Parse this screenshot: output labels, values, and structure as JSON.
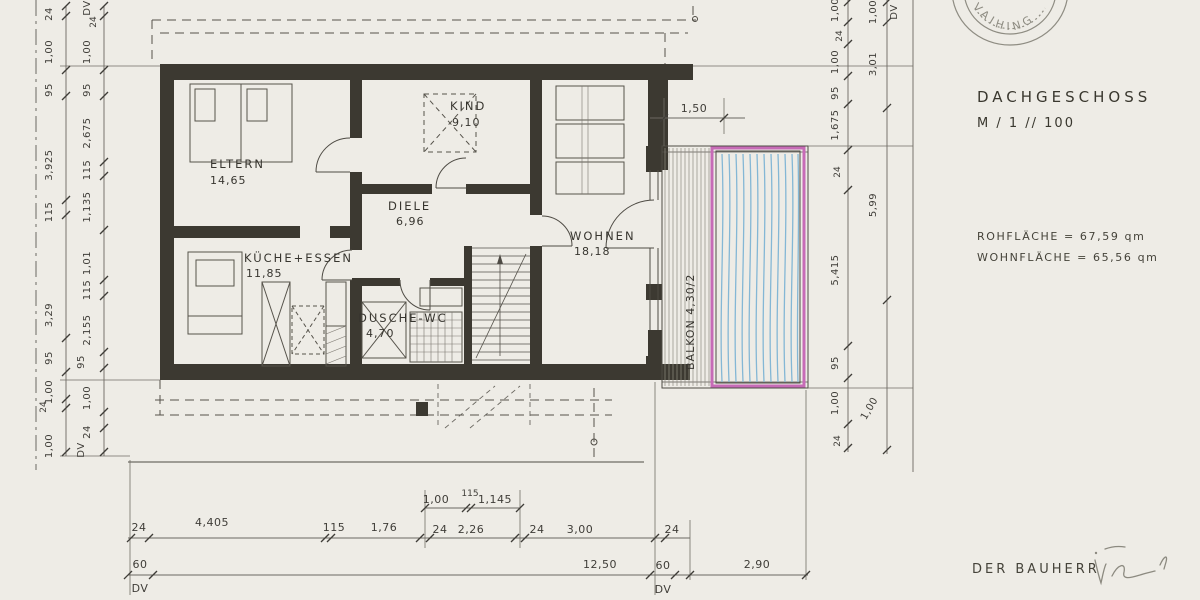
{
  "rooms": {
    "eltern": {
      "name": "ELTERN",
      "area": "14,65"
    },
    "kind": {
      "name": "KIND",
      "area": "9,10"
    },
    "diele": {
      "name": "DIELE",
      "area": "6,96"
    },
    "wohnen": {
      "name": "WOHNEN",
      "area": "18,18"
    },
    "kueche": {
      "name": "KÜCHE+ESSEN",
      "area": "11,85"
    },
    "dusche": {
      "name": "DUSCHE-WC",
      "area": "4,70"
    },
    "balkon": {
      "name": "BALKON 4,30/2"
    }
  },
  "info": {
    "floor_title": "DACHGESCHOSS",
    "scale": "M / 1 // 100",
    "rohflaeche": "ROHFLÄCHE = 67,59 qm",
    "wohnflaeche": "WOHNFLÄCHE = 65,56 qm",
    "bauherr_label": "DER BAUHERR",
    "stamp_text": "VAIHING"
  },
  "dims": {
    "balcony_width": "1,50",
    "left_outer": [
      "24",
      "1,00",
      "95",
      "3,925",
      "115",
      "3,29",
      "95",
      "1,00",
      "24",
      "1,00"
    ],
    "left_inner": [
      "DV",
      "24",
      "1,00",
      "95",
      "2,675",
      "115",
      "1,135",
      "1,01",
      "115",
      "2,155",
      "95",
      "1,00",
      "24",
      "DV"
    ],
    "right_inner": [
      "1,00",
      "24",
      "1,00",
      "95",
      "1,675",
      "24",
      "5,415",
      "95",
      "1,00",
      "24"
    ],
    "right_outer": [
      "1,00",
      "DV",
      "3,01",
      "5,99",
      "1,00"
    ],
    "bottom_sub": [
      "1,00",
      "115",
      "1,145"
    ],
    "bottom_row1": [
      "24",
      "4,405",
      "115",
      "1,76",
      "24",
      "2,26",
      "24",
      "3,00",
      "24"
    ],
    "bottom_row2": [
      "60",
      "12,50",
      "60",
      "2,90"
    ],
    "bottom_row3": [
      "DV",
      "DV"
    ]
  }
}
